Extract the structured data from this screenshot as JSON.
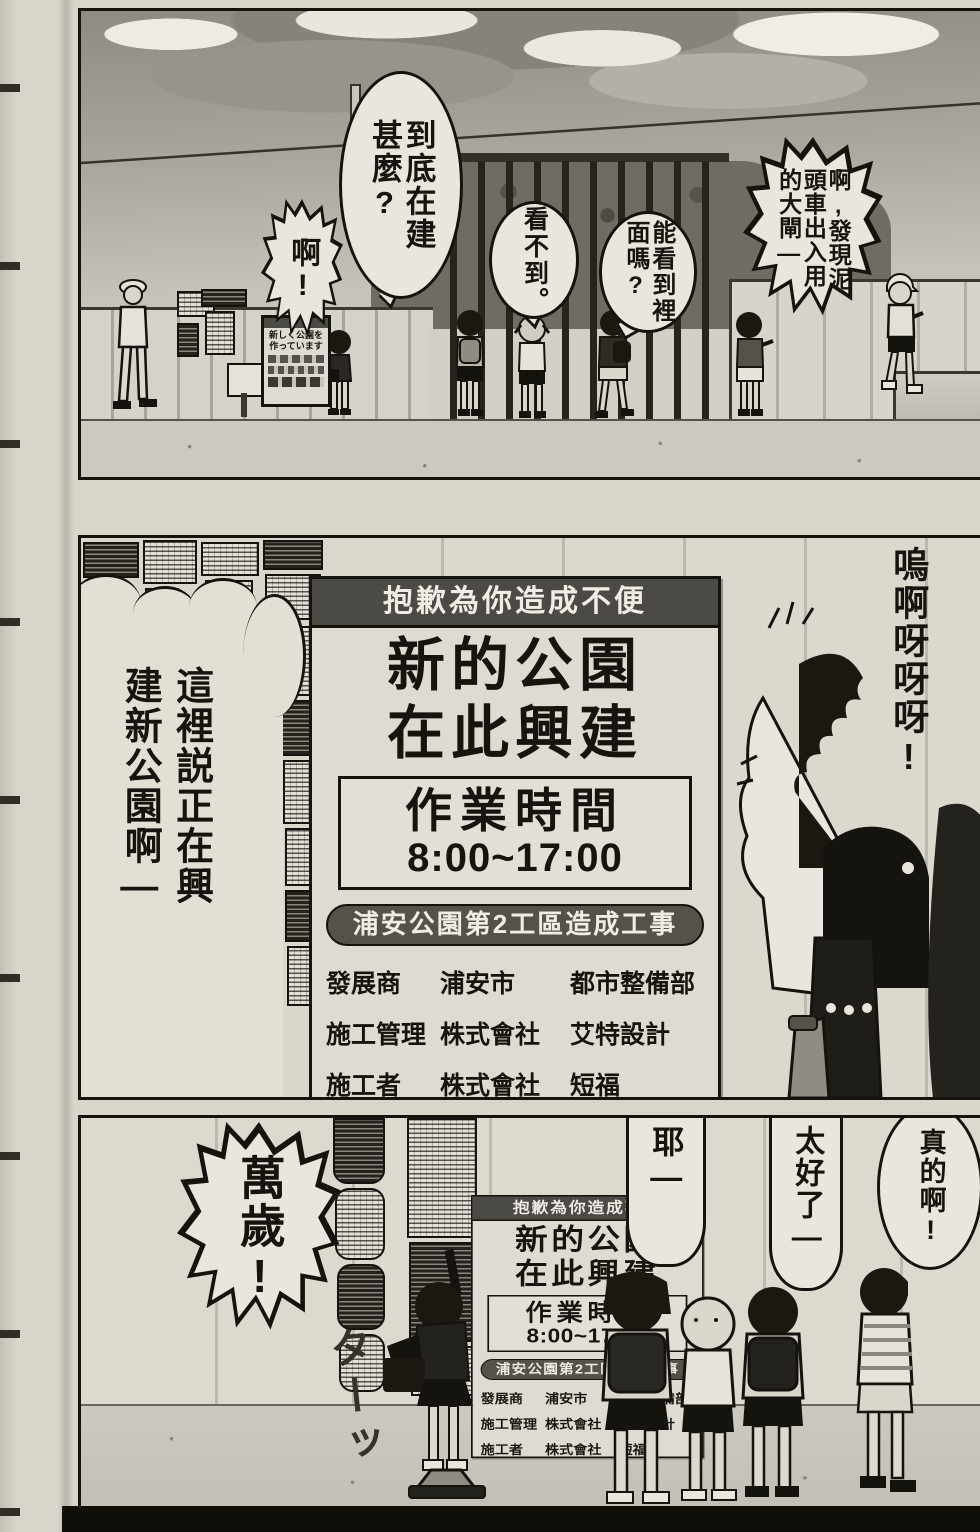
{
  "colors": {
    "paper": "#d8d5ca",
    "ink": "#17140f",
    "sign_header_bg": "#4c4a45",
    "sign_bg": "#dedbd2",
    "project_band_bg": "#55524c",
    "sky_dark": "#8e8b83",
    "sky_light": "#cfccc3"
  },
  "panel1": {
    "bubbles": {
      "what": "到底在建\n甚麼?",
      "ah": "啊!",
      "cant_see": "看不到。",
      "see_inside": "能看到裡\n面嗎?",
      "gate": "啊,發現泥\n頭車出入用\n的大閘—"
    },
    "fence_sign": "新しく公園を\n作っています"
  },
  "panel2": {
    "narration": "這裡説正在興\n建新公園啊—",
    "scream": "嗚啊呀呀呀!"
  },
  "sign": {
    "header": "抱歉為你造成不便",
    "title_line1": "新的公園",
    "title_line2": "在此興建",
    "hours_label": "作業時間",
    "hours_value": "8:00~17:00",
    "project_band": "浦安公園第2工區造成工事",
    "table": {
      "rows": [
        [
          "發展商",
          "浦安市",
          "都市整備部"
        ],
        [
          "施工管理",
          "株式會社",
          "艾特設計"
        ],
        [
          "施工者",
          "株式會社",
          "短福"
        ]
      ]
    }
  },
  "panel3": {
    "banzai": "萬歲!",
    "yeah": "耶—",
    "great": "太好了—",
    "really": "真的啊!",
    "sfx": "ターッ"
  }
}
